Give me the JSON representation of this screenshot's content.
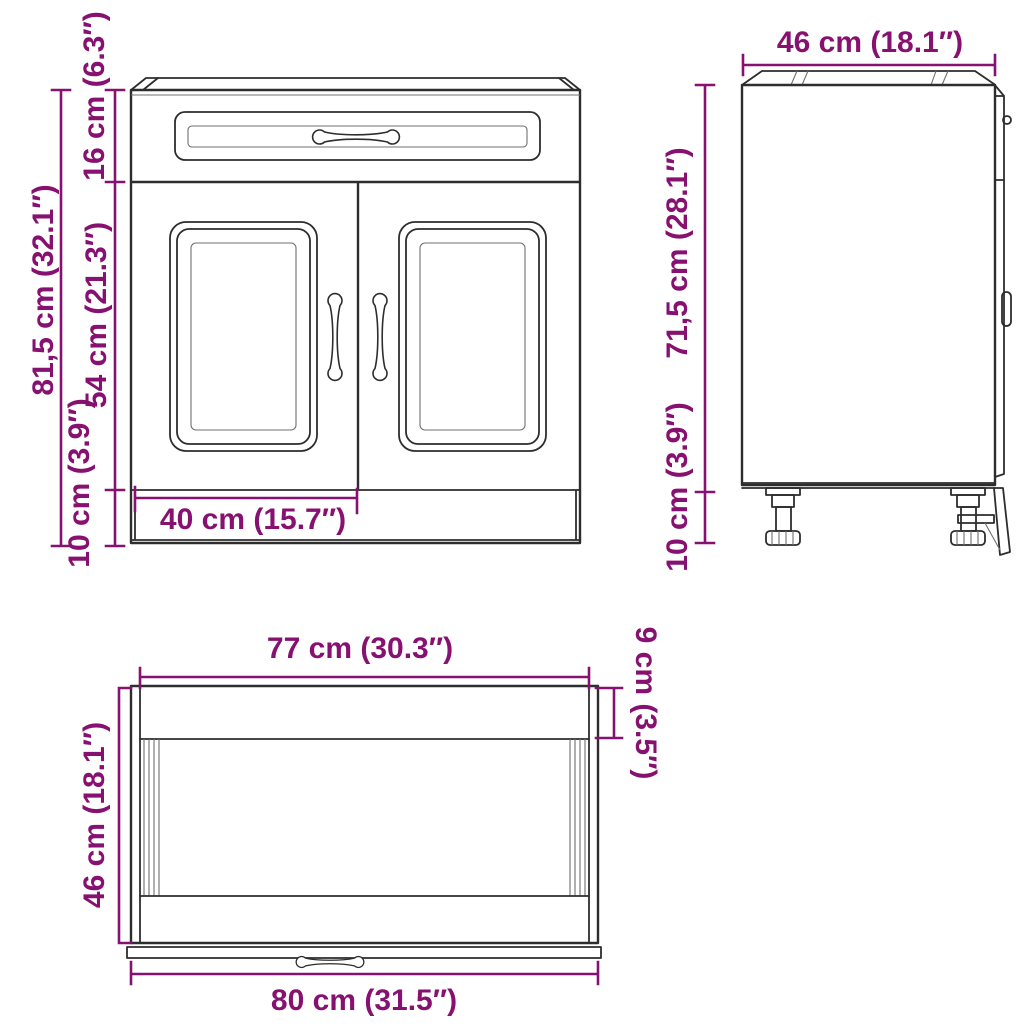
{
  "drawing_title": "Kitchen base cabinet dimension drawing",
  "views": {
    "front": {
      "dims": {
        "total_height": "81,5 cm (32.1″)",
        "top_section_height": "16 cm (6.3″)",
        "door_height": "54 cm (21.3″)",
        "plinth_height": "10 cm (3.9″)",
        "half_width": "40 cm (15.7″)"
      }
    },
    "side": {
      "dims": {
        "depth": "46 cm (18.1″)",
        "body_height": "71,5 cm (28.1″)",
        "leg_height": "10 cm (3.9″)"
      }
    },
    "bottom": {
      "dims": {
        "inner_width": "77 cm (30.3″)",
        "back_strip_depth": "9 cm (3.5″)",
        "depth": "46 cm (18.1″)",
        "total_width": "80 cm (31.5″)"
      }
    }
  },
  "colors": {
    "dimension": "#871170",
    "outline": "#2d2d2d",
    "outline_light": "#707070",
    "background": "#ffffff"
  }
}
